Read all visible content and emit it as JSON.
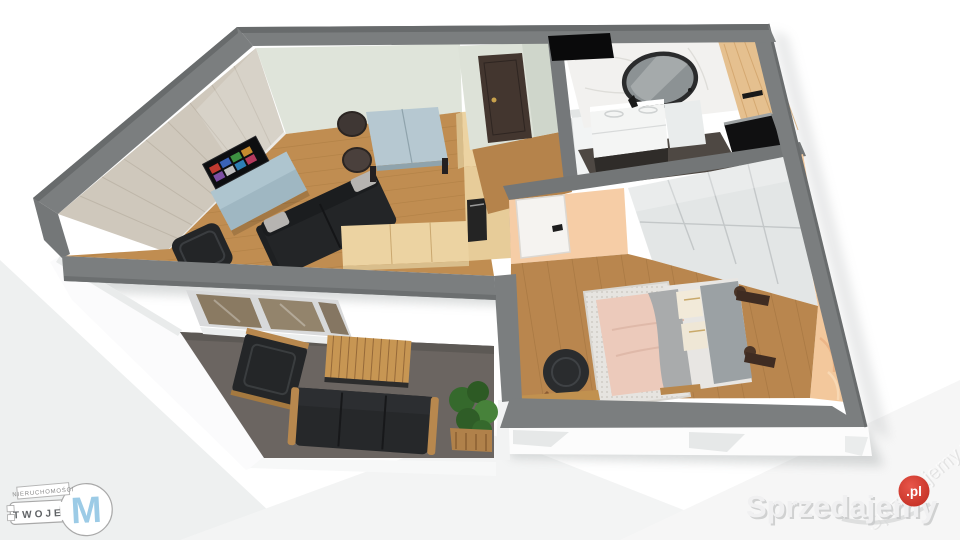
{
  "meta": {
    "view": "isometric-3d-floorplan-render"
  },
  "palette": {
    "wall_gray": "#7b7e7f",
    "wall_gray_dark": "#686b6c",
    "wall_band_inner": "#737677",
    "floor_living": "#c08d51",
    "floor_bedroom": "#b9864e",
    "floor_hall": "#b5834b",
    "floor_balcony": "#6b6561",
    "wall_mint": "#dfe4da",
    "wall_plank": "#cfc8bc",
    "wall_marble": "#f2f1ef",
    "wall_bath_wood": "#e5c08f",
    "wall_peach": "#f6cda6",
    "wallpaper_peach": "#f3c89c",
    "kitchen_wood": "#ecd3a2",
    "kitchen_wood_side": "#d8bd8a",
    "tv_cabinet_blue": "#aec5cf",
    "dining_table_blue": "#b6c8d1",
    "sofa_dark": "#232527",
    "entrance_door_brown": "#43362f",
    "wardrobe_white": "#e3e6e6",
    "bed_duvet_pink": "#eccabb",
    "bed_blanket_gray": "#a9abac",
    "bed_headboard_gray": "#9ba1a4",
    "rug_white": "#e6e4e0",
    "outdoor_wood": "#b8884e",
    "coffee_table_wood": "#c79653",
    "plant_green": "#35692c",
    "slab_white": "#fbfbfc",
    "glass_tint": "#8a7a62",
    "brand_red": "#d8382c",
    "logo_blue": "#9ccbe6"
  },
  "watermark": {
    "brand_text": "Sprzedajemy",
    "brand_tld": ".pl",
    "ghost_text": "Sprzedajemy.pl"
  },
  "agency_logo": {
    "top_label": "NIERUCHOMOŚCI",
    "name": "TWOJE",
    "monogram": "M"
  },
  "scene": {
    "rooms": [
      {
        "name": "living-room",
        "furniture": [
          "tv-sideboard",
          "tv",
          "sofa",
          "armchair",
          "dining-table",
          "dining-chairs"
        ]
      },
      {
        "name": "kitchenette",
        "furniture": [
          "l-shaped-counter",
          "built-in-appliance"
        ]
      },
      {
        "name": "hallway",
        "furniture": [
          "entrance-door",
          "tall-cabinet"
        ]
      },
      {
        "name": "bathroom",
        "furniture": [
          "round-mirror",
          "vanity-sink",
          "shower-glass"
        ]
      },
      {
        "name": "bedroom",
        "furniture": [
          "double-bed",
          "sliding-wardrobe",
          "armchair",
          "desk-bench",
          "rug"
        ]
      },
      {
        "name": "balcony",
        "furniture": [
          "outdoor-armchair",
          "outdoor-sofa",
          "coffee-table",
          "planter"
        ]
      }
    ]
  }
}
